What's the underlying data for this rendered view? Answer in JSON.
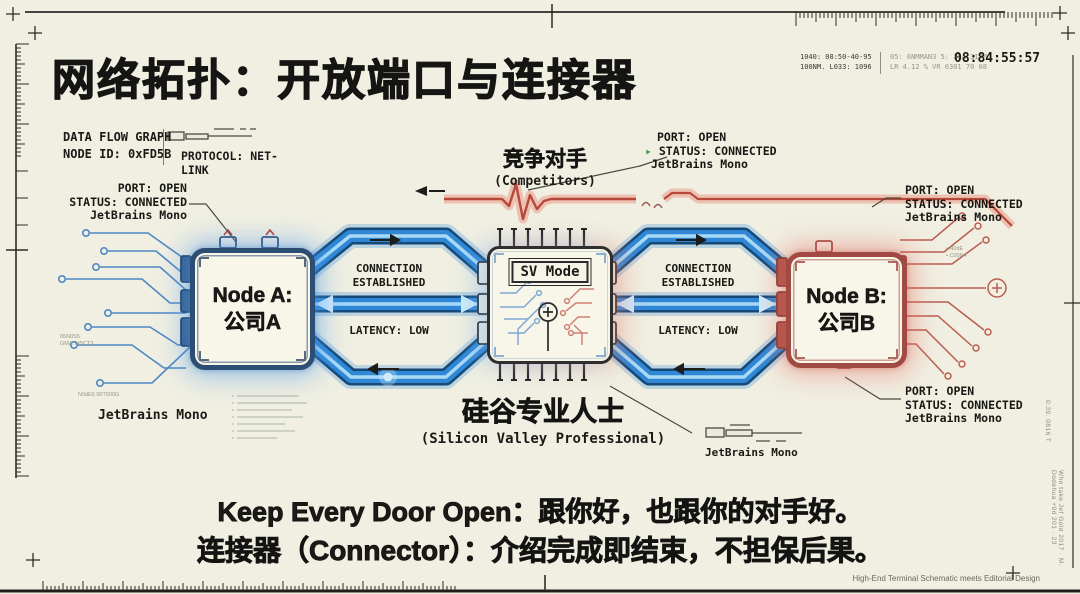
{
  "title": "网络拓扑：开放端口与连接器",
  "hud": {
    "telemetry_a1": "1040: 08:50-40-95",
    "telemetry_a2": "100NM. L033: 1096",
    "telemetry_b1": "05: 6NMMAN3 5: 2RA 317M",
    "telemetry_b2": "LR 4.12 %  VR 0301 70 08",
    "timestamp": "08:84:55:57"
  },
  "info_box": {
    "title": "DATA FLOW GRAPH",
    "node_id": "NODE ID: 0xFD5B",
    "protocol": "PROTOCOL: NET-LINK"
  },
  "port_labels": {
    "node_a_top": {
      "l1": "PORT: OPEN",
      "l2": "STATUS: CONNECTED",
      "l3": "JetBrains Mono"
    },
    "competitors_link": {
      "l1": "PORT: OPEN",
      "icon": "▸",
      "l2": "STATUS: CONNECTED",
      "l3": "JetBrains Mono"
    },
    "node_b_top": {
      "l1": "PORT: OPEN",
      "l2": "STATUS: CONNECTED",
      "l3": "JetBrains Mono"
    },
    "node_b_bottom": {
      "l1": "PORT: OPEN",
      "l2": "STATUS: CONNECTED",
      "l3": "JetBrains Mono"
    }
  },
  "nodes": {
    "a": {
      "name": "Node A:",
      "company": "公司A"
    },
    "b": {
      "name": "Node B:",
      "company": "公司B"
    },
    "hub": {
      "mode": "SV Mode",
      "title_cn": "硅谷专业人士",
      "title_en": "(Silicon Valley Professional)"
    }
  },
  "links": {
    "left": {
      "connection_1": "CONNECTION",
      "connection_2": "ESTABLISHED",
      "latency": "LATENCY: LOW"
    },
    "right": {
      "connection_1": "CONNECTION",
      "connection_2": "ESTABLISHED",
      "latency": "LATENCY: LOW"
    }
  },
  "competitors": {
    "cn": "竞争对手",
    "en": "(Competitors)"
  },
  "annotations": {
    "jetbrains_left": "JetBrains Mono",
    "jetbrains_connector": "JetBrains Mono",
    "credit": "High-End Terminal Schematic meets Editorial Design"
  },
  "micro": {
    "left_1": "65N0S5",
    "left_2": "GMA 745CT3",
    "bottom_left": "N0dE5 00T500G",
    "right_1": "• N0dE",
    "right_2": "• C00N4",
    "edge_right": "0:39. 0816 T",
    "edge_bottom_right": "Who take Jef Gold 2017 · M. Dodehua +9d 201 · 23"
  },
  "tagline": {
    "line1": "Keep Every Door Open：跟你好，也跟你的对手好。",
    "line2": "连接器（Connector）：介绍完成即结束，不担保后果。"
  },
  "colors": {
    "background": "#f0efe2",
    "ink": "#1b1a17",
    "pipe_blue": "#2f87d6",
    "pipe_dark": "#154a78",
    "node_a_border": "#2c4e74",
    "node_b_border": "#a14a44",
    "red_wire": "#b8483a",
    "trace_blue": "#4e87c2",
    "trace_red": "#bb5d50",
    "green_prompt": "#3f9a4c"
  }
}
